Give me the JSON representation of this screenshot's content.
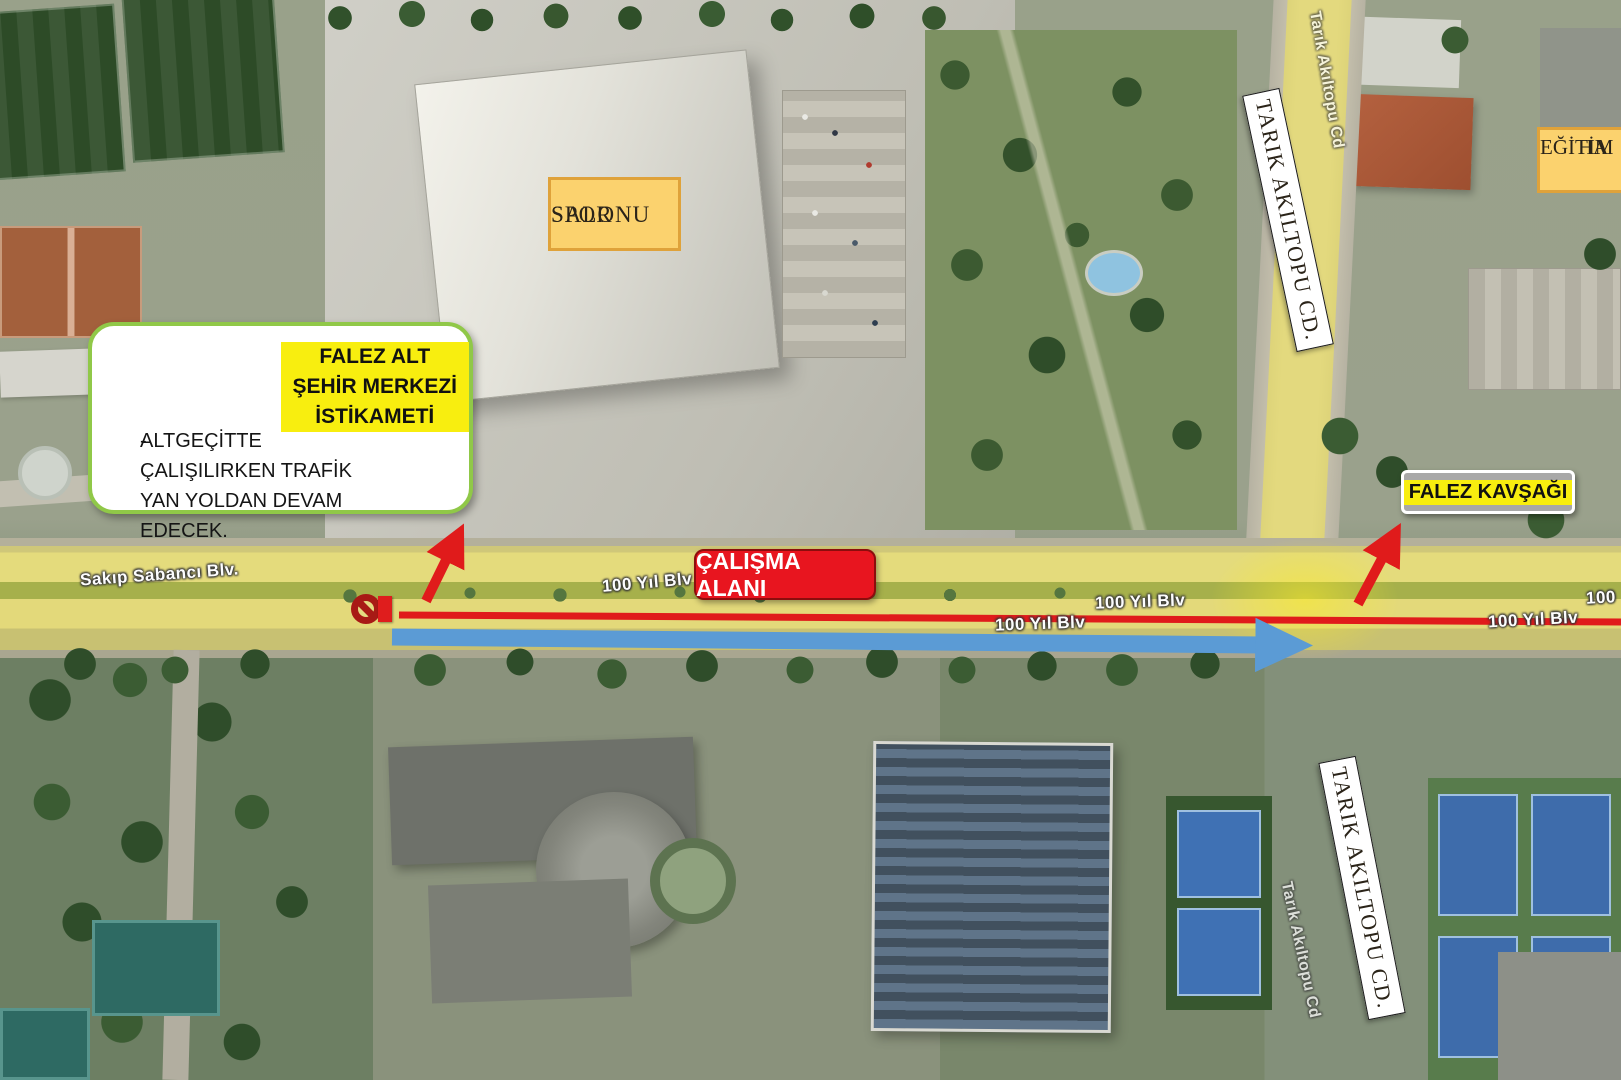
{
  "callout": {
    "title_line1": "FALEZ ALT GEÇİDİ",
    "title_line2": "ŞEHİR MERKEZİ İSTİKAMETİ",
    "bullet_dash": "-",
    "bullet_text": "ALTGEÇİTTE ÇALIŞILIRKEN TRAFİK YAN YOLDAN DEVAM EDECEK."
  },
  "plates": {
    "spor_line1": "SPOR",
    "spor_line2": "SALONU",
    "egitim_line1": "EĞİTİM",
    "egitim_line2": "HA",
    "tarik_top": "TARIK AKILTOPU CD.",
    "tarik_bottom": "TARIK AKILTOPU CD."
  },
  "boxes": {
    "calisma_alani": "ÇALIŞMA ALANI",
    "falez_kavsagi": "FALEZ KAVŞAĞI"
  },
  "streets": {
    "sakip_sabanci": "Sakıp Sabancı Blv.",
    "yil_blv_1": "100 Yıl Blv",
    "yil_blv_2": "100 Yıl Blv",
    "yil_blv_3": "100 Yıl Blv",
    "yil_blv_4": "100 Yıl Blv",
    "yil_blv_partial": "100",
    "tarik_faint_top": "Tarık Akıltopu Cd",
    "tarik_faint_bottom": "Tarık Akıltopu Cd"
  },
  "icons": {
    "no_entry": "no-entry-prohibition-sign",
    "closure_marker": "road-closure-red-marker",
    "red_arrows": "diversion-arrow",
    "blue_arrow": "traffic-flow-arrow"
  },
  "colors": {
    "highlight_yellow": "#f8ee0f",
    "road_highlight_yellow": "#f7e947",
    "arrow_red": "#e01b1b",
    "arrow_blue": "#5b9bd5",
    "work_box_red": "#e8151f",
    "plate_orange_bg": "#fbd26e",
    "plate_orange_border": "#dfa23a",
    "callout_border_green": "#90c848",
    "kavsagi_gray": "#a8a8a8"
  }
}
